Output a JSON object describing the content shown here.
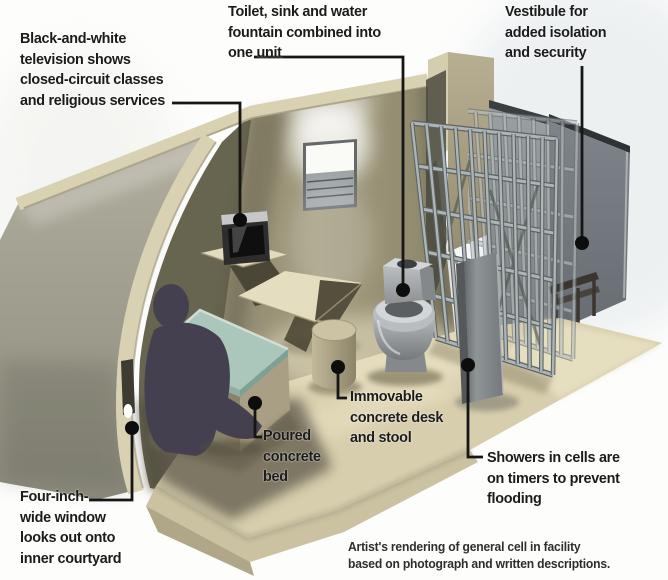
{
  "labels": {
    "television": {
      "lines": [
        "Black-and-white",
        "television shows",
        "closed-circuit classes",
        "and religious services"
      ]
    },
    "toilet": {
      "lines": [
        "Toilet, sink and water",
        "fountain combined into",
        "one unit"
      ]
    },
    "vestibule": {
      "lines": [
        "Vestibule for",
        "added isolation",
        "and security"
      ]
    },
    "shower": {
      "lines": [
        "Showers in cells are",
        "on timers to prevent",
        "flooding"
      ]
    },
    "desk": {
      "lines": [
        "Immovable",
        "concrete desk",
        "and stool"
      ]
    },
    "bed": {
      "lines": [
        "Poured",
        "concrete",
        "bed"
      ]
    },
    "window": {
      "lines": [
        "Four-inch-",
        "wide window",
        "looks out onto",
        "inner courtyard"
      ]
    }
  },
  "caption": {
    "lines": [
      "Artist's rendering of general cell in facility",
      "based on photograph and written descriptions."
    ]
  },
  "colors": {
    "label_text": "#1b1b1b",
    "callout_line": "#161616",
    "wall_cream_edge": "#d8d1b2",
    "wall_exterior": "#a3a192",
    "wall_interior": "#9a9377",
    "floor": "#d7cead",
    "bed_mat": "#abc7bc",
    "figure_silhouette": "#454050",
    "metal_fixture": "#a9adaf",
    "cell_bars": "#adb5b7",
    "vestibule_panel": "#757b80",
    "shower_panel": "#8f9496",
    "background": "#fdfdfc"
  }
}
